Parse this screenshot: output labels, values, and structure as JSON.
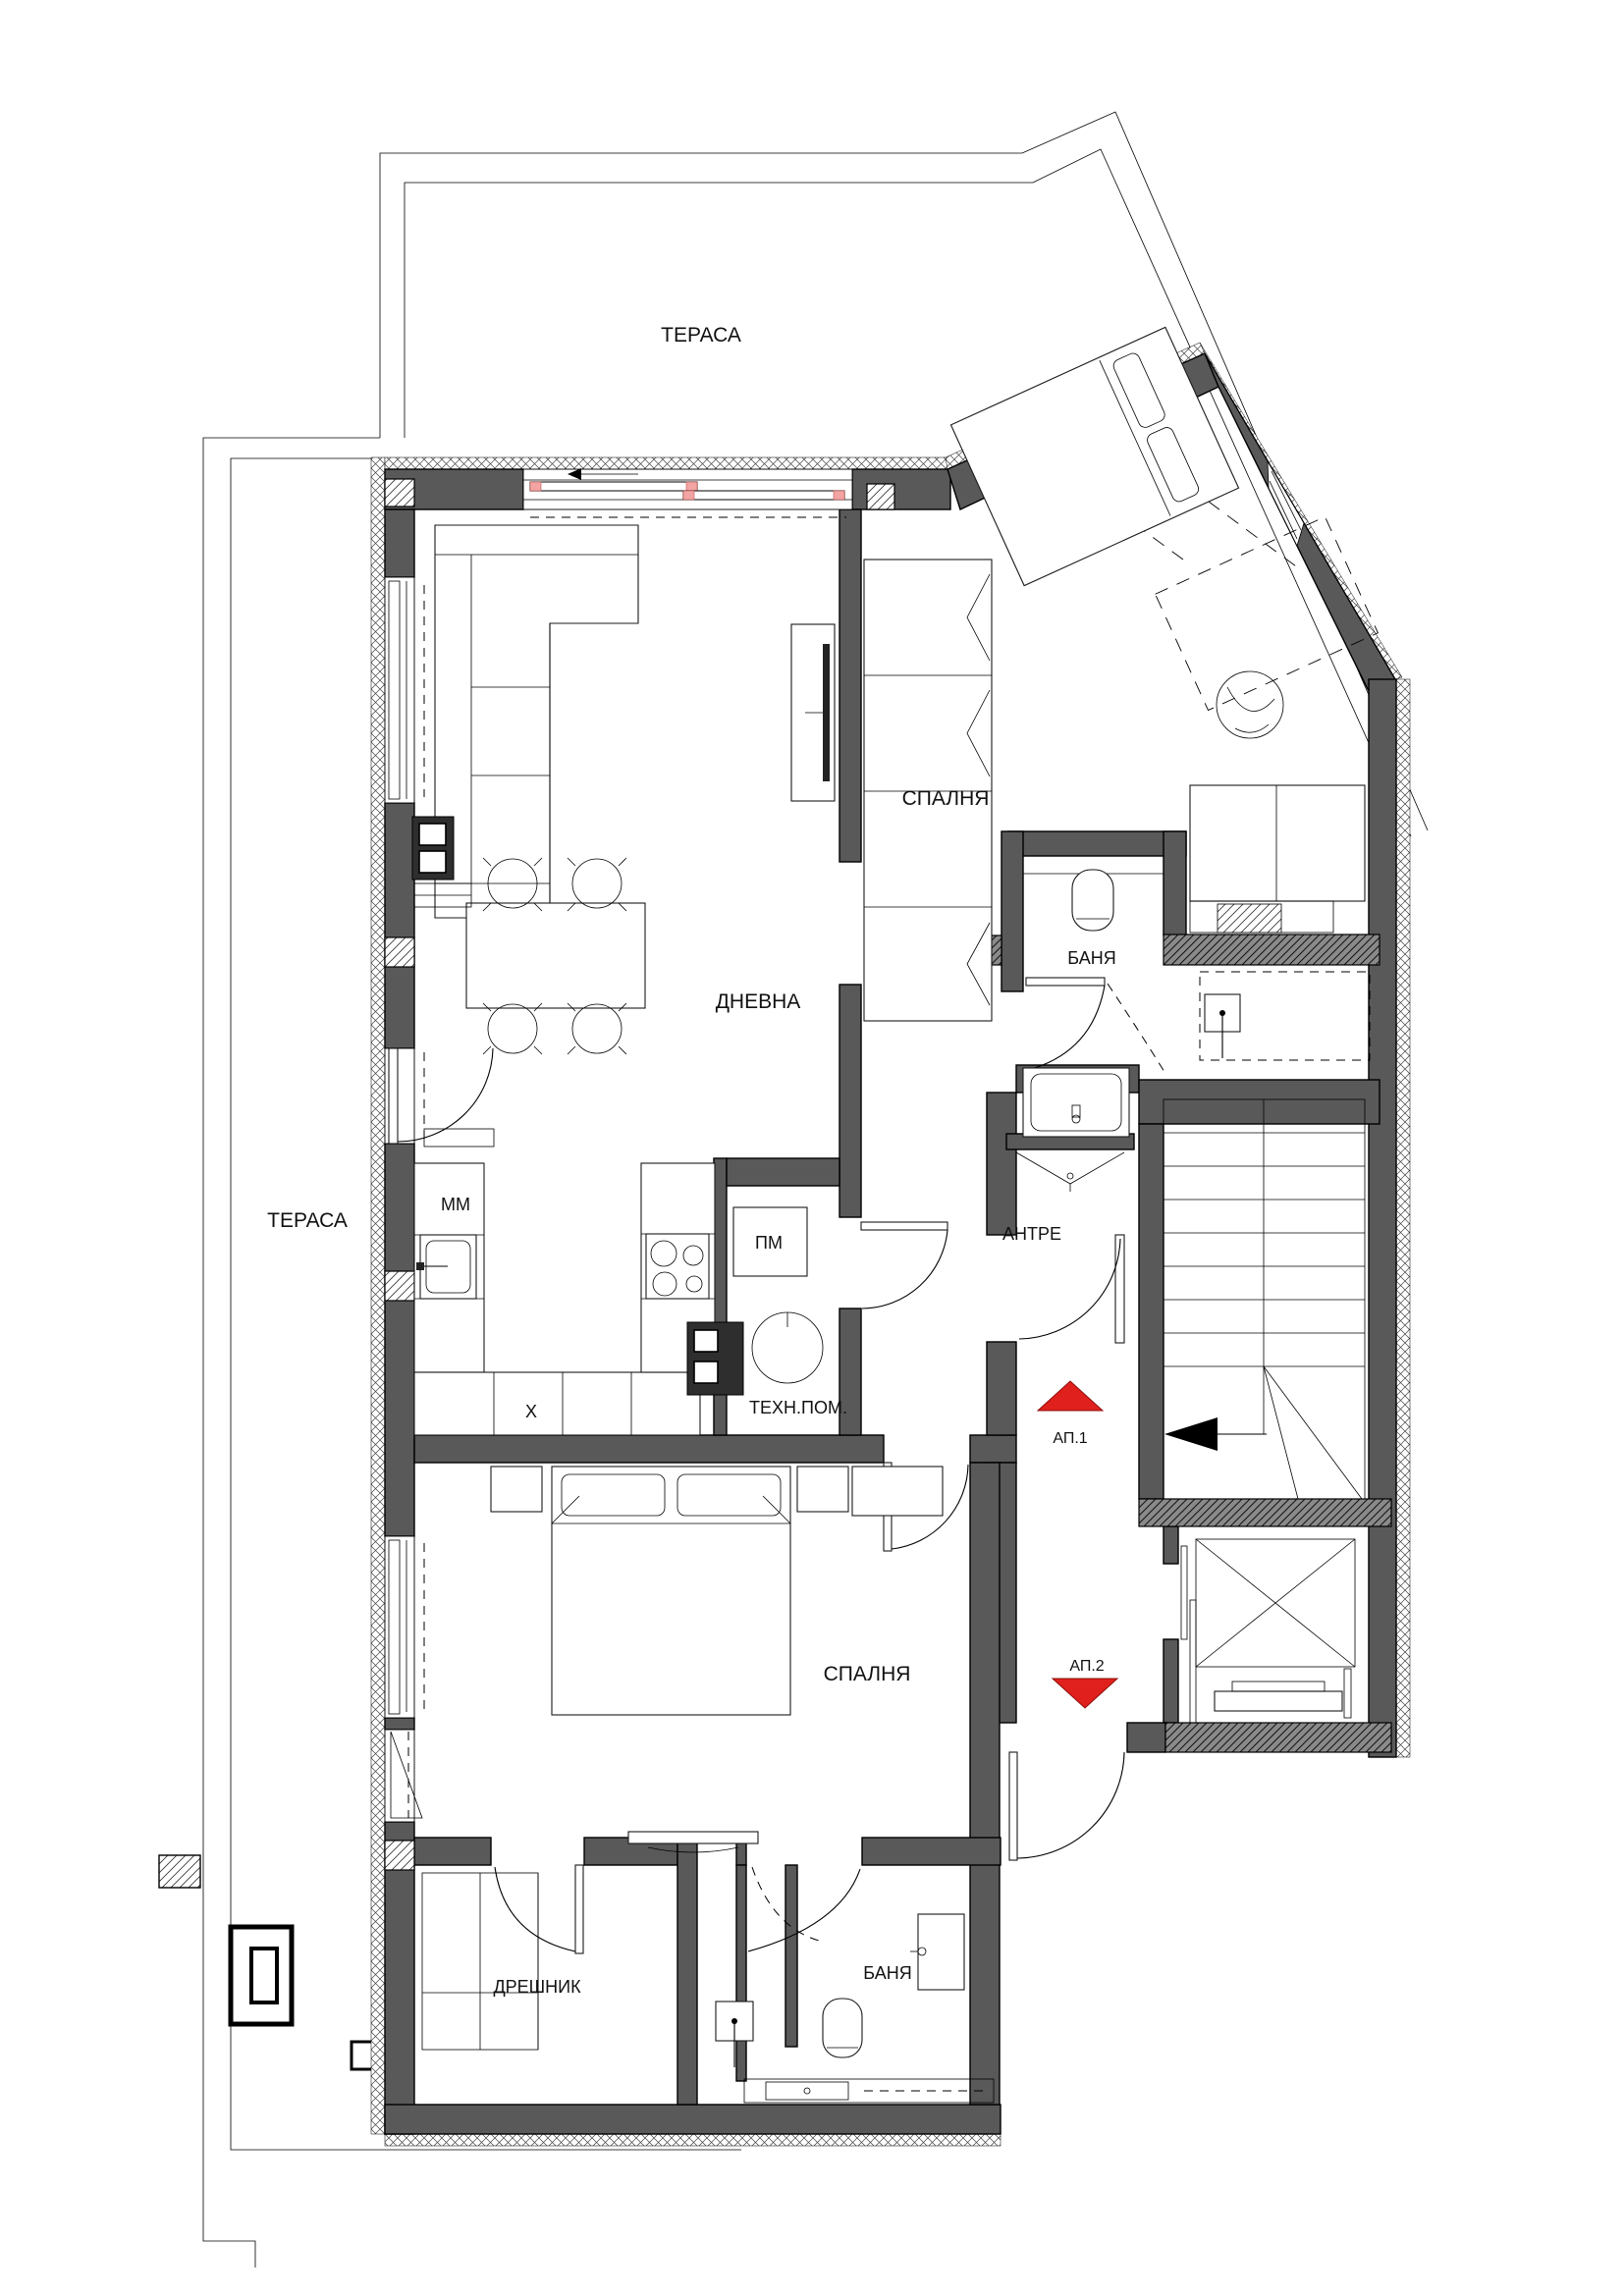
{
  "drawing": {
    "type": "apartment floor plan",
    "language": "Bulgarian"
  },
  "colors": {
    "wall": "#595959",
    "marker_red": "#e0201c",
    "window_pink": "#f2a5a2"
  },
  "labels": {
    "terrace_top": "ТЕРАСА",
    "terrace_left": "ТЕРАСА",
    "bedroom_top": "СПАЛНЯ",
    "bathroom_top": "БАНЯ",
    "living_room": "ДНЕВНА",
    "kitchen_unit_mm": "ММ",
    "kitchen_unit_pm": "ПМ",
    "kitchen_unit_x": "Х",
    "tech_room": "ТЕХН.ПОМ.",
    "hall": "АНТРЕ",
    "apartment_1": "АП.1",
    "apartment_2": "АП.2",
    "bedroom_bottom": "СПАЛНЯ",
    "closet": "ДРЕШНИК",
    "bathroom_bottom": "БАНЯ"
  },
  "markers": {
    "apartment_1_direction": "up",
    "apartment_2_direction": "down",
    "stairs_direction": "left"
  }
}
